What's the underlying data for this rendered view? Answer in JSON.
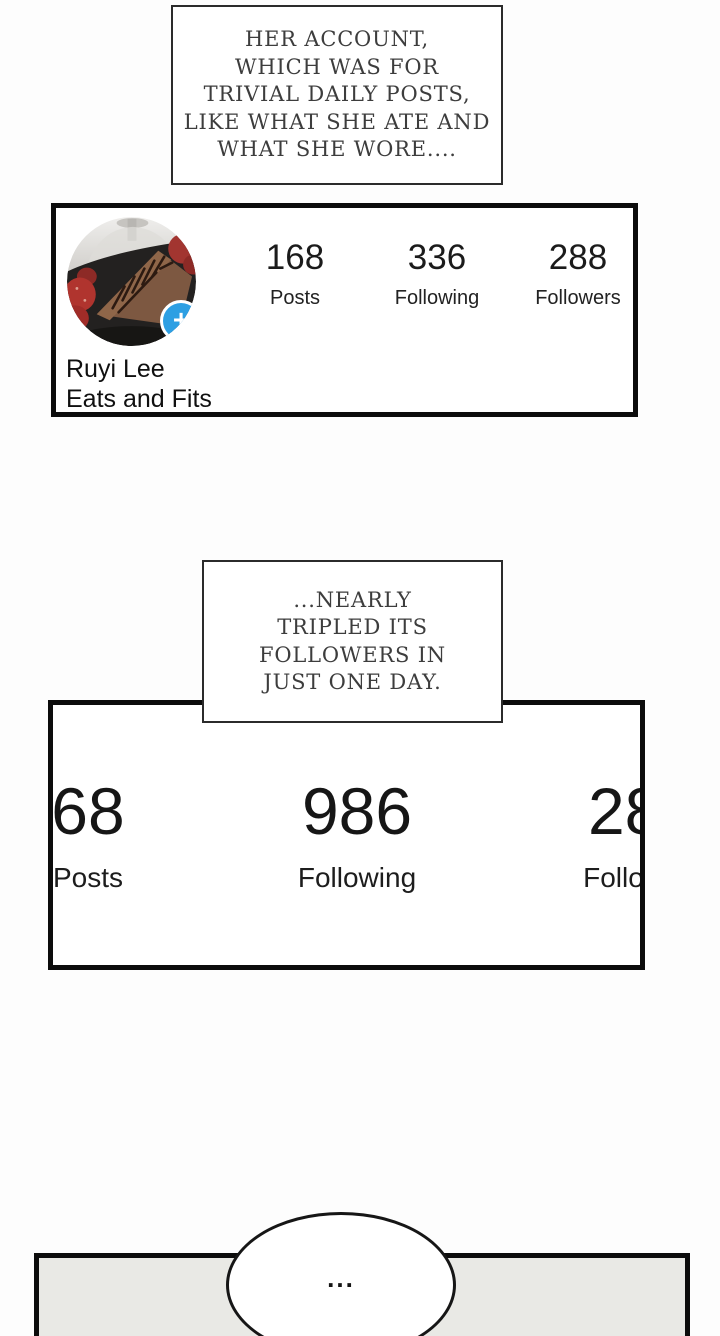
{
  "page": {
    "background": "#fdfdfd",
    "panel_border_color": "#0c0c0c"
  },
  "caption_top": {
    "lines": [
      "HER ACCOUNT,",
      "WHICH WAS FOR",
      "TRIVIAL DAILY POSTS,",
      "LIKE WHAT SHE ATE AND",
      "WHAT SHE WORE...."
    ]
  },
  "profile_panel": {
    "name": "Ruyi Lee",
    "bio": "Eats and Fits",
    "avatar": {
      "icon": "chocolate-cake-with-strawberries-photo",
      "plus_badge": "+",
      "badge_color": "#2d9fe3"
    },
    "stats": [
      {
        "value": "168",
        "label": "Posts"
      },
      {
        "value": "336",
        "label": "Following"
      },
      {
        "value": "288",
        "label": "Followers"
      }
    ]
  },
  "caption_mid": {
    "lines": [
      "...NEARLY",
      "TRIPLED ITS",
      "FOLLOWERS IN",
      "JUST ONE DAY."
    ]
  },
  "zoomed_panel": {
    "stats": [
      {
        "value": "68",
        "label": "Posts"
      },
      {
        "value": "986",
        "label": "Following"
      },
      {
        "value": "288",
        "label": "Followers"
      }
    ]
  },
  "bottom_panel": {
    "bubble_text": "..."
  }
}
